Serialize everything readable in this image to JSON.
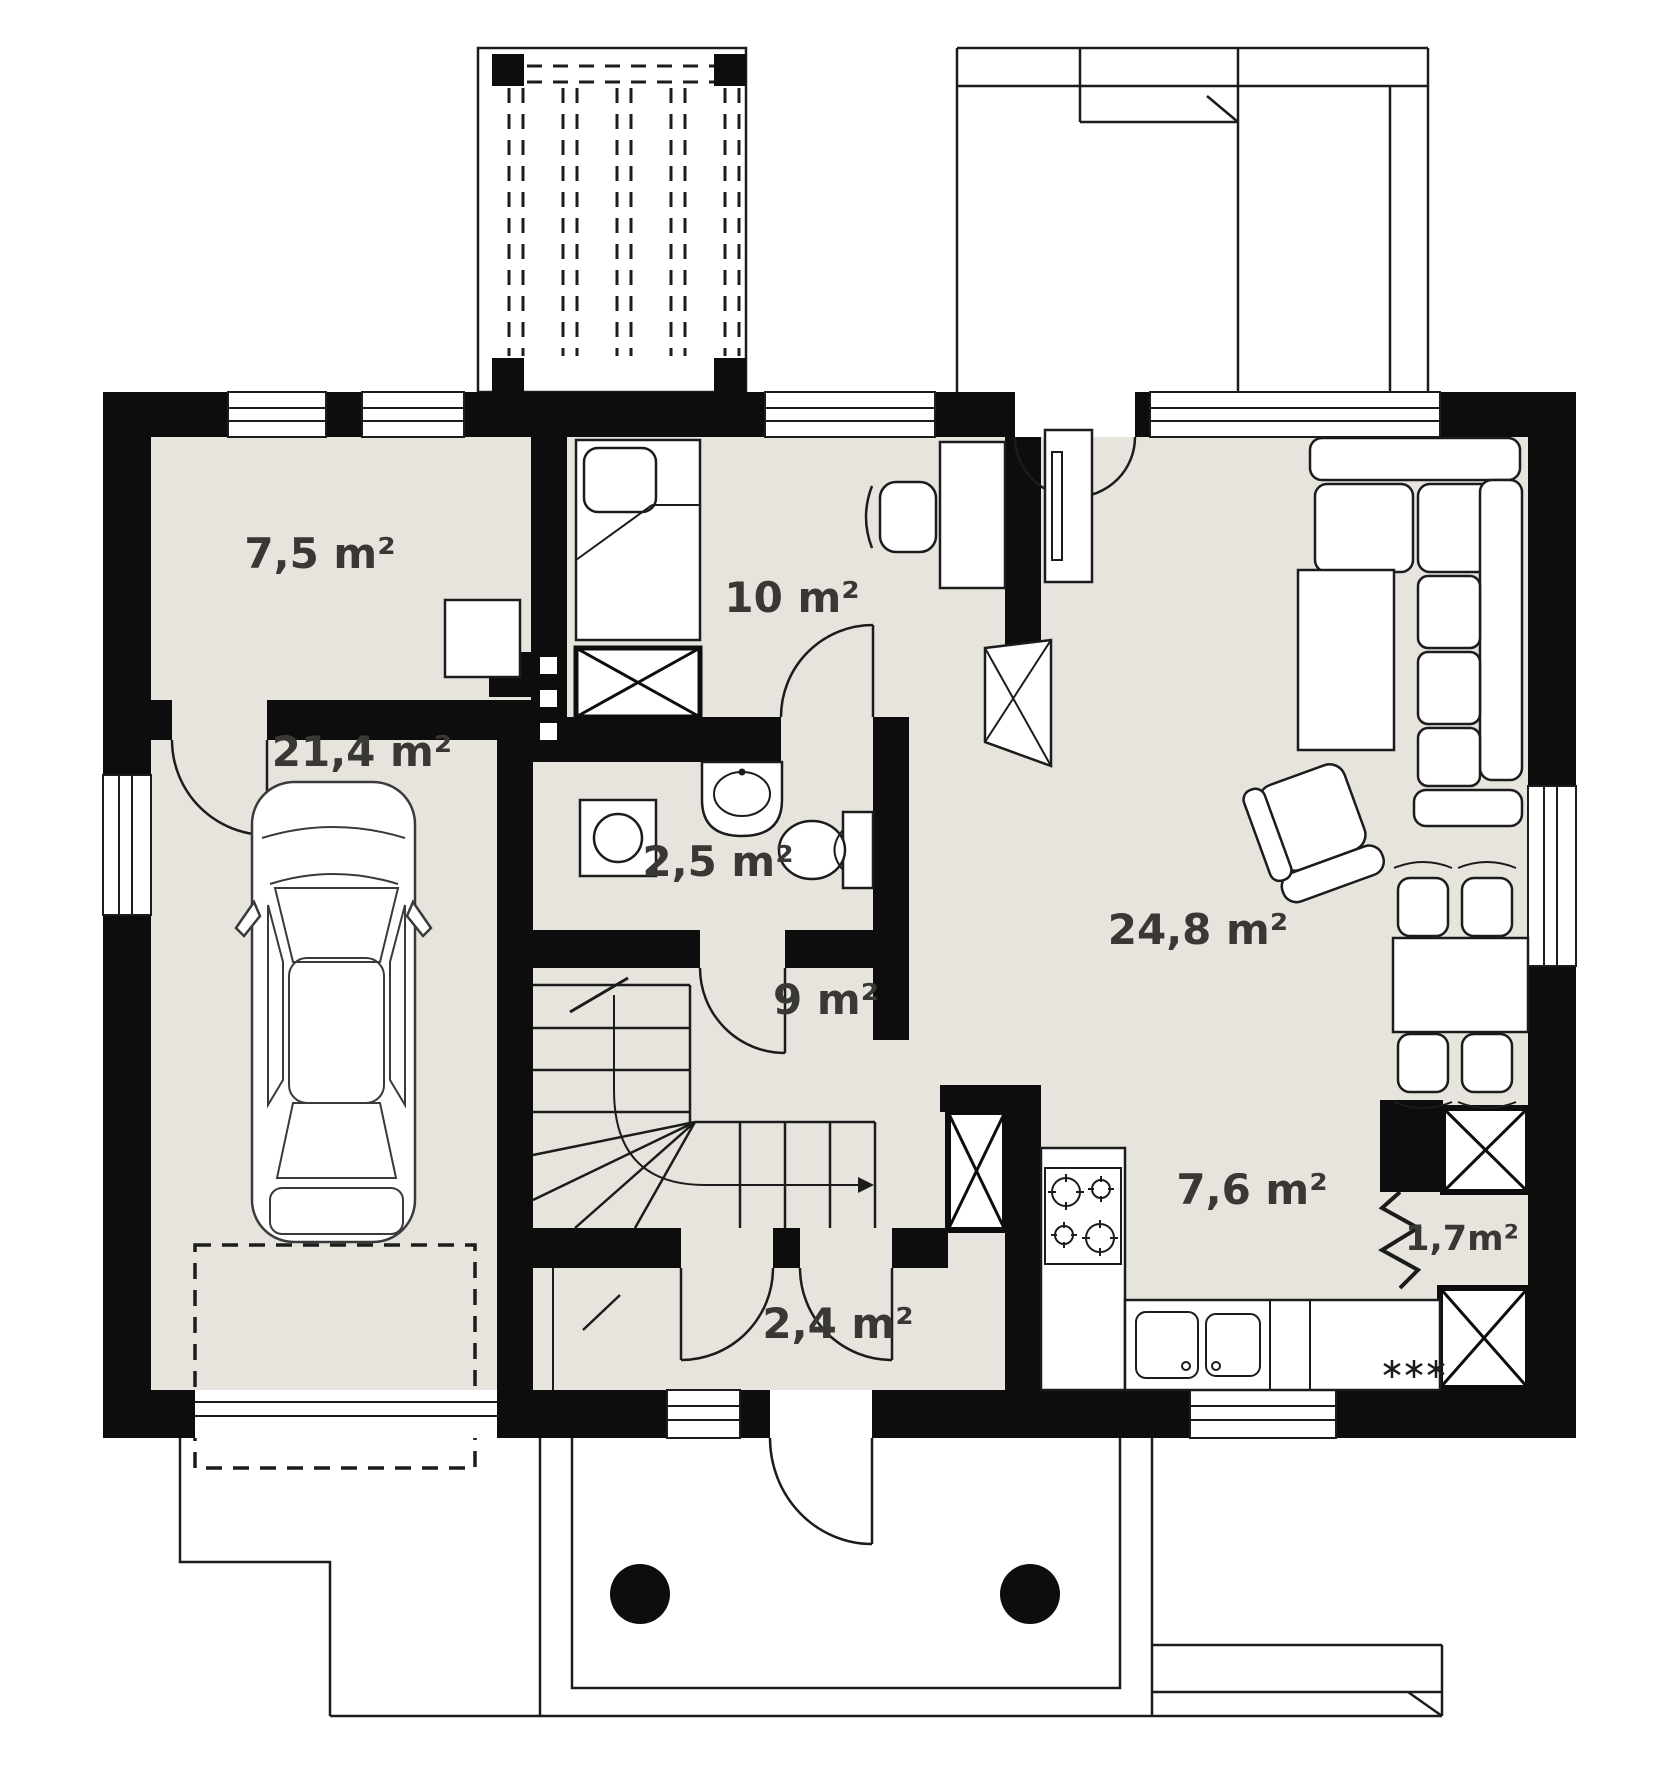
{
  "title": "Ground floor plan",
  "colors": {
    "background": "#ffffff",
    "floor": "#e7e4de",
    "wall": "#0d0d0d",
    "line": "#1c1c1c",
    "label": "#3a3835"
  },
  "rooms": [
    {
      "name": "utility-room",
      "label": "7,5 m²"
    },
    {
      "name": "bedroom",
      "label": "10 m²"
    },
    {
      "name": "garage",
      "label": "21,4 m²"
    },
    {
      "name": "bathroom",
      "label": "2,5 m²"
    },
    {
      "name": "hall",
      "label": "9 m²"
    },
    {
      "name": "living-room",
      "label": "24,8 m²"
    },
    {
      "name": "kitchen",
      "label": "7,6 m²"
    },
    {
      "name": "pantry",
      "label": "1,7m²"
    },
    {
      "name": "vestibule",
      "label": "2,4 m²"
    }
  ],
  "furniture": [
    "car",
    "single-bed",
    "wardrobe",
    "desk",
    "desk-chair",
    "washing-machine",
    "washbasin",
    "toilet",
    "staircase",
    "corner-sofa",
    "coffee-table",
    "tv-unit",
    "armchair",
    "fireplace",
    "dining-table",
    "dining-chair",
    "cooktop",
    "kitchen-sink",
    "dishwasher",
    "ventilation-shaft",
    "pergola",
    "porch-column"
  ]
}
